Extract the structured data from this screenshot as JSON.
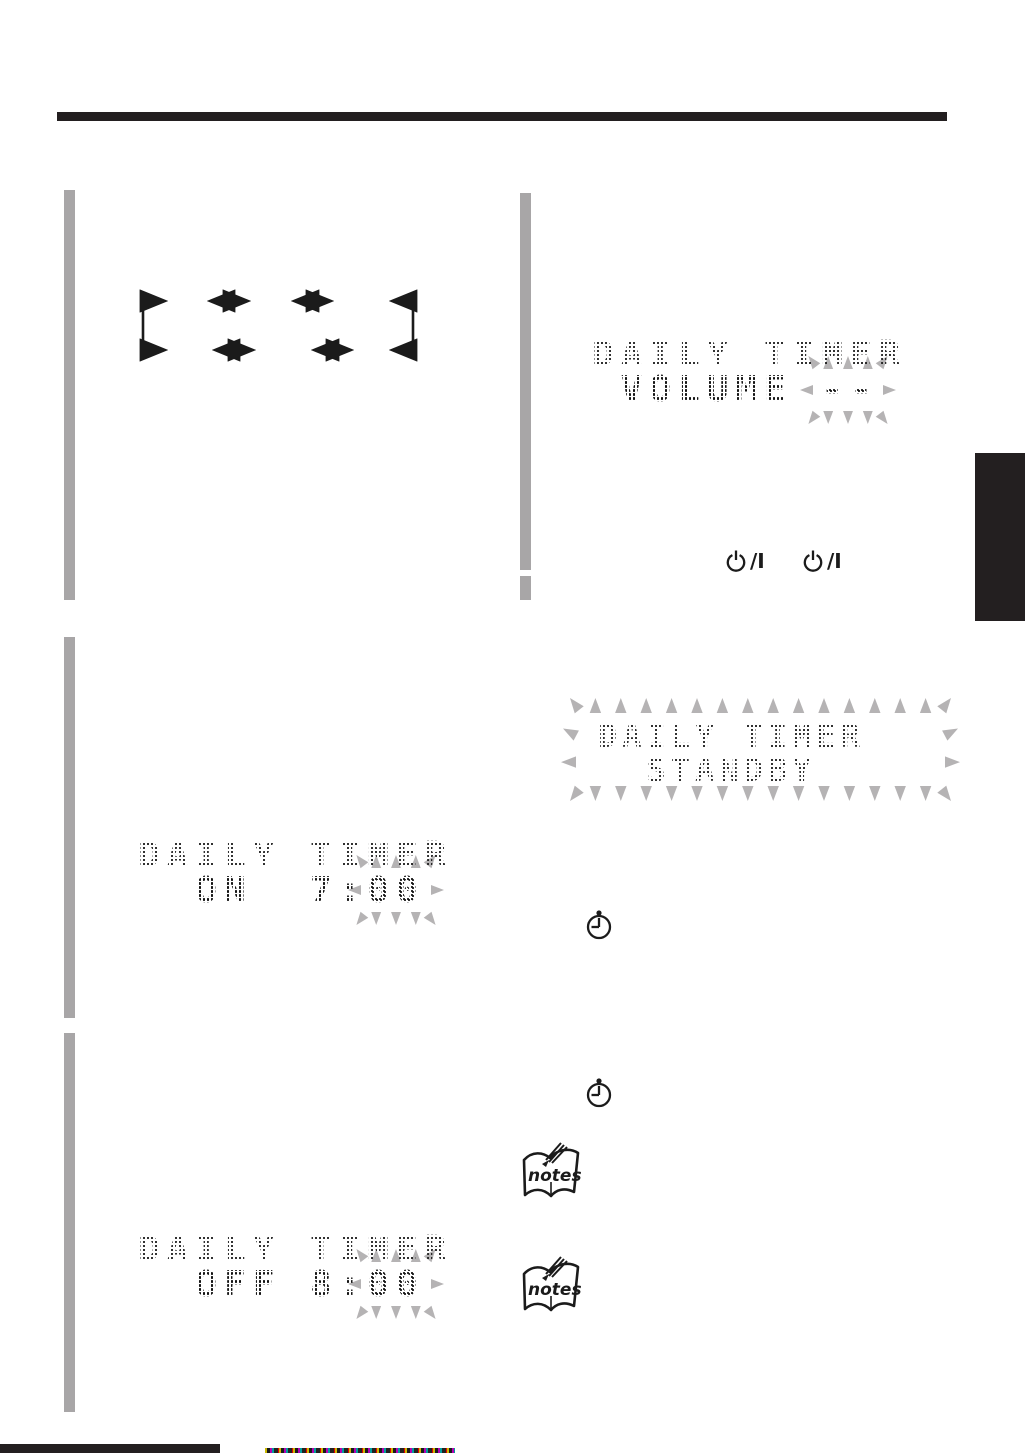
{
  "displays": {
    "volume": {
      "line1": "DAILY TIMER",
      "line2_prefix": " VOLUME ",
      "blink_value": "--"
    },
    "standby": {
      "line1": "DAILY TIMER",
      "line2": "  STANDBY"
    },
    "on_timer": {
      "line1": "DAILY TIMER",
      "line2_prefix": "  ON  7:",
      "blink_value": "00"
    },
    "off_timer": {
      "line1": "DAILY TIMER",
      "line2_prefix": "  OFF 8:",
      "blink_value": "00"
    }
  },
  "icons": {
    "power_suffix": "/I",
    "notes_label": "notes"
  },
  "colors": {
    "rule_black": "#231f20",
    "step_bar_gray": "#a8a6a7",
    "flash_burst_gray": "#b5b3b4",
    "lcd_dot_black": "#161616"
  }
}
